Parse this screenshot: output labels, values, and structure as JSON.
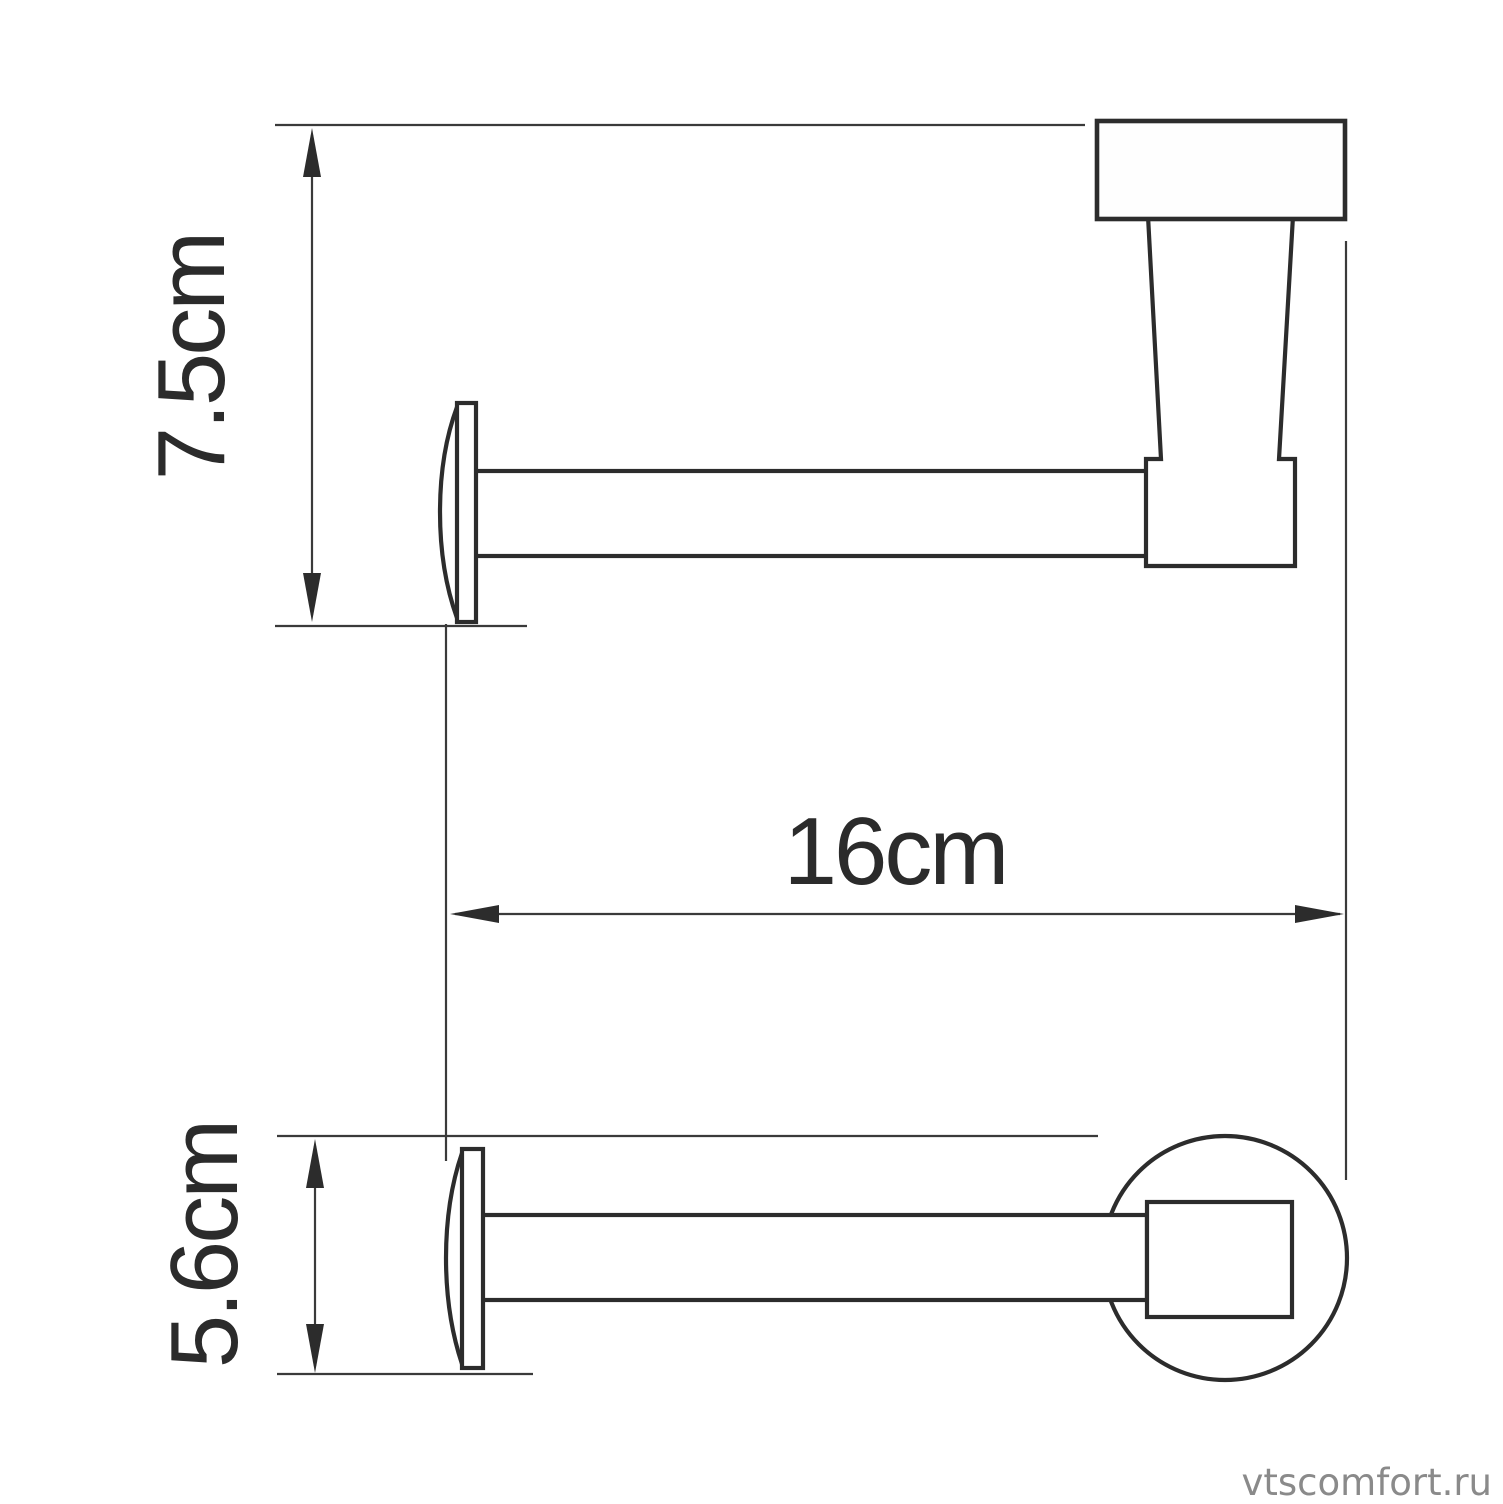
{
  "diagram": {
    "subject": "toilet-paper-holder technical drawing, two projection views",
    "dimensions": {
      "height": {
        "label": "7.5cm",
        "value_cm": 7.5,
        "orientation": "vertical"
      },
      "length": {
        "label": "16cm",
        "value_cm": 16,
        "orientation": "horizontal"
      },
      "depth": {
        "label": "5.6cm",
        "value_cm": 5.6,
        "orientation": "vertical"
      }
    },
    "colors": {
      "outline": "#2c2c2c",
      "dimension_line": "#3a3a3a",
      "label_text": "#2b2b2b",
      "background": "#ffffff"
    }
  },
  "watermark": {
    "text": "vtscomfort.ru",
    "color": "#8a8a8a"
  }
}
